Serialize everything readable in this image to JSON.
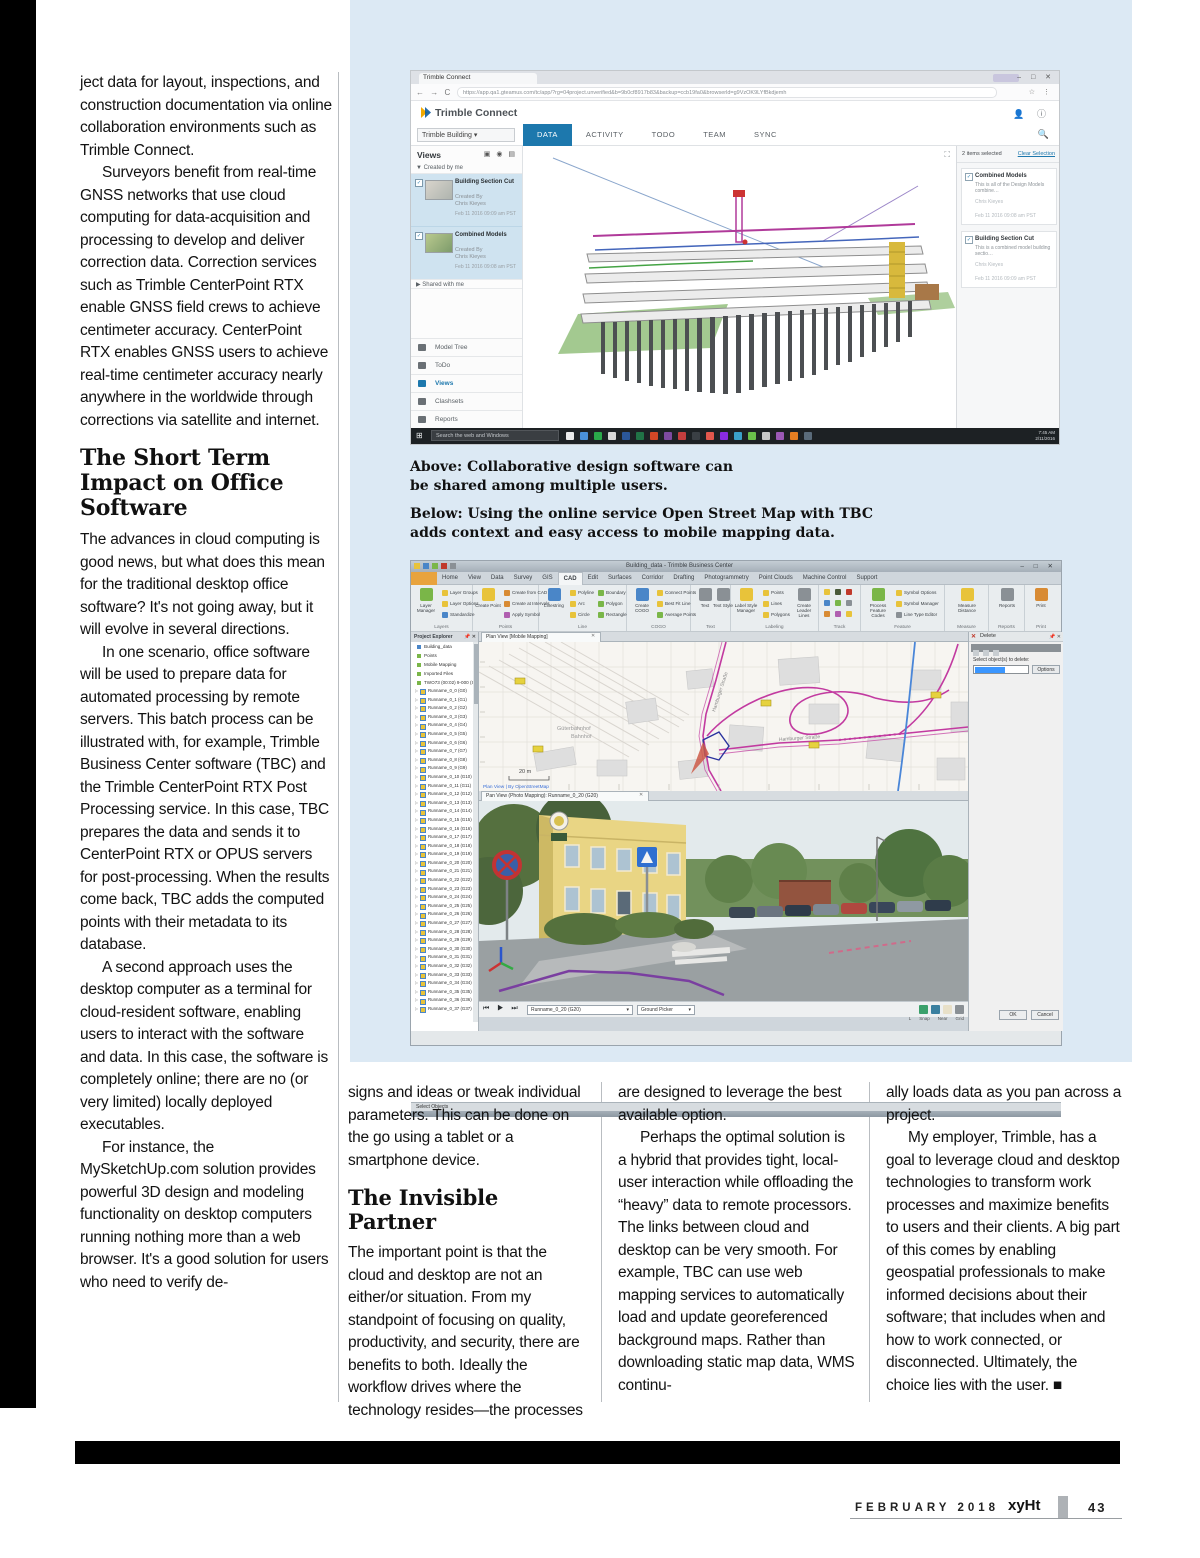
{
  "article": {
    "left_column": {
      "para1": "ject data for layout, inspections, and construction documentation via online collaboration environments such as Trimble Connect.",
      "para2": "Surveyors benefit from real-time GNSS networks that use cloud computing for data-acquisition and processing to develop and deliver correction data. Correction services such as Trimble CenterPoint RTX enable GNSS field crews to achieve centimeter accuracy. CenterPoint RTX enables GNSS users to achieve real-time centimeter accuracy nearly anywhere in the worldwide through corrections via satellite and internet.",
      "heading": "The Short Term Impact on Office Software",
      "para3": "The advances in cloud computing is good news, but what does this mean for the traditional desktop office software? It's not going away, but it will evolve in several directions.",
      "para4": "In one scenario, office software will be used to prepare data for automated processing by remote servers. This batch process can be illustrated with, for example, Trimble Business Center software (TBC) and the Trimble CenterPoint RTX Post Processing service. In this case, TBC prepares the data and sends it to CenterPoint RTX or OPUS servers for post-processing. When the results come back, TBC adds the computed points with their metadata to its database.",
      "para5": "A second approach uses the desktop computer as a terminal for cloud-resident software, enabling users to interact with the software and data. In this case, the software is completely online; there are no (or very limited) locally deployed executables.",
      "para6": "For instance, the MySketchUp.com solution provides powerful 3D design and modeling functionality on desktop computers running nothing more than a web browser. It's a good solution for users who need to verify de-"
    },
    "captions": {
      "above": "Above: Collaborative design software can be shared among multiple users.",
      "below": "Below: Using the online service Open Street Map with TBC adds context and easy access to mobile mapping data."
    },
    "columns": {
      "col1_para1": "signs and ideas or tweak individual parameters. This can be done on the go using a tablet or a smartphone device.",
      "col1_heading": "The Invisible Partner",
      "col1_para2": "The important point is that the cloud and desktop are not an either/or situation. From my standpoint of focusing on quality, productivity, and security, there are benefits to both. Ideally the workflow drives where the technology resides—the processes",
      "col2_para1": "are designed to leverage the best available option.",
      "col2_para2": "Perhaps the optimal solution is a hybrid that provides tight, local-user interaction while offloading the “heavy” data to remote processors. The links between cloud and desktop can be very smooth. For example, TBC can use web mapping services to automatically load and update georeferenced background maps. Rather than downloading static map data, WMS continu-",
      "col3_para1": "ally loads data as you pan across a project.",
      "col3_para2": "My employer, Trimble, has a goal to leverage cloud and desktop technologies to transform work processes and maximize benefits to users and their clients. A big part of this comes by enabling geospatial professionals to make informed decisions about their software; that includes when and how to work connected, or disconnected. Ultimately, the choice lies with the user. ■"
    },
    "footer": {
      "date": "FEBRUARY 2018",
      "brand": "xyHt",
      "page": "43"
    }
  },
  "tc": {
    "browser": {
      "tab_title": "Trimble Connect",
      "url": "https://app.qa1.gteamus.com/tc/app/?rg=04project.unverified&b=9b0cf8917b83&backup=ccb19fa0&browserld=g9VzOK9LYfBkdjemh"
    },
    "brand": "Trimble Connect",
    "project_selector": "Trimble Building ▾",
    "tabs": [
      {
        "label": "DATA"
      },
      {
        "label": "ACTIVITY"
      },
      {
        "label": "TODO"
      },
      {
        "label": "TEAM"
      },
      {
        "label": "SYNC"
      }
    ],
    "left": {
      "views_label": "Views",
      "created_group": "▼ Created by me",
      "shared_group": "▶ Shared with me",
      "items": [
        {
          "title": "Building Section Cut",
          "by": "Created By",
          "author": "Chris Kieyes",
          "date": "Feb 11 2016 09:09 am PST"
        },
        {
          "title": "Combined Models",
          "by": "Created By",
          "author": "Chris Kieyes",
          "date": "Feb 11 2016 09:08 am PST"
        }
      ],
      "nav": [
        "Model Tree",
        "ToDo",
        "Views",
        "Clashsets",
        "Reports"
      ]
    },
    "right": {
      "count_label": "2 items selected",
      "clear_label": "Clear Selection",
      "items": [
        {
          "title": "Combined Models",
          "desc": "This is all of the Design Models combine…",
          "author": "Chris Kieyes",
          "date": "Feb 11 2016 09:08 am PST"
        },
        {
          "title": "Building Section Cut",
          "desc": "This is a combined model building sectio…",
          "author": "Chris Kieyes",
          "date": "Feb 11 2016 09:09 am PST"
        }
      ]
    },
    "taskbar": {
      "search": "Search the web and Windows",
      "time": "7:45 AM",
      "date": "2/11/2016"
    }
  },
  "tbc": {
    "title": "Building_data - Trimble Business Center",
    "ribbon_tabs": [
      {
        "label": "Home"
      },
      {
        "label": "View"
      },
      {
        "label": "Data"
      },
      {
        "label": "Survey"
      },
      {
        "label": "GIS"
      },
      {
        "label": "CAD"
      },
      {
        "label": "Edit"
      },
      {
        "label": "Surfaces"
      },
      {
        "label": "Corridor"
      },
      {
        "label": "Drafting"
      },
      {
        "label": "Photogrammetry"
      },
      {
        "label": "Point Clouds"
      },
      {
        "label": "Machine Control"
      },
      {
        "label": "Support"
      }
    ],
    "ribbon": {
      "layers": {
        "big": "Layer Manager",
        "i1": "Layer Groups",
        "i2": "Layer Options",
        "i3": "Standardize",
        "label": "Layers"
      },
      "points": {
        "big": "Create Point",
        "i1": "Create from CAD",
        "i2": "Create at Intervals",
        "i3": "Apply Symbol",
        "label": "Points"
      },
      "line": {
        "big": "Linestring",
        "a1": "Polyline",
        "a2": "Arc",
        "a3": "Circle",
        "b1": "Boundary",
        "b2": "Polygon",
        "b3": "Rectangle",
        "label": "Line"
      },
      "cogo": {
        "big": "Create COGO",
        "i1": "Connect Points",
        "i2": "Best Fit Line",
        "i3": "Average Points",
        "label": "COGO"
      },
      "text": {
        "b1": "Text",
        "b2": "Text Style",
        "label": "Text"
      },
      "labeling": {
        "big": "Label Style Manager",
        "i1": "Points",
        "i2": "Lines",
        "i3": "Polygons",
        "big2": "Create Leader Lines",
        "label": "Labeling"
      },
      "track": {
        "label": "Track"
      },
      "feature": {
        "big": "Process Feature Codes",
        "i1": "Symbol Options",
        "i2": "Symbol Manager",
        "i3": "Line Type Editor",
        "label": "Feature"
      },
      "measure": {
        "big": "Measure Distance",
        "label": "Measure"
      },
      "reports": {
        "big": "Reports",
        "label": "Reports"
      },
      "print": {
        "big": "Print",
        "label": "Print"
      }
    },
    "explorer": {
      "title": "Project Explorer",
      "root": "Building_data",
      "nodes": [
        "Points",
        "Mobile Mapping",
        "Imported Files",
        "TWO73 (00:02) 9-000 (Sh…"
      ],
      "runs": [
        "Runname_0_0 (G0)",
        "Runname_0_1 (G1)",
        "Runname_0_2 (G2)",
        "Runname_0_3 (G3)",
        "Runname_0_4 (G4)",
        "Runname_0_5 (G5)",
        "Runname_0_6 (G6)",
        "Runname_0_7 (G7)",
        "Runname_0_8 (G8)",
        "Runname_0_9 (G9)",
        "Runname_0_10 (G10)",
        "Runname_0_11 (G11)",
        "Runname_0_12 (G12)",
        "Runname_0_13 (G13)",
        "Runname_0_14 (G14)",
        "Runname_0_15 (G15)",
        "Runname_0_16 (G16)",
        "Runname_0_17 (G17)",
        "Runname_0_18 (G18)",
        "Runname_0_19 (G19)",
        "Runname_0_20 (G20)",
        "Runname_0_21 (G21)",
        "Runname_0_22 (G22)",
        "Runname_0_23 (G23)",
        "Runname_0_24 (G24)",
        "Runname_0_25 (G25)",
        "Runname_0_26 (G26)",
        "Runname_0_27 (G27)",
        "Runname_0_28 (G28)",
        "Runname_0_29 (G29)",
        "Runname_0_30 (G30)",
        "Runname_0_31 (G31)",
        "Runname_0_32 (G32)",
        "Runname_0_33 (G33)",
        "Runname_0_34 (G34)",
        "Runname_0_35 (G35)",
        "Runname_0_36 (G36)",
        "Runname_0_37 (G37)"
      ]
    },
    "plan": {
      "tab": "Plan View [Mobile Mapping]",
      "label_station1": "Güterbahnhof",
      "label_station2": "Bahnhof",
      "label_road1": "Hamburger Straße",
      "label_road2": "Hamburger Straße",
      "scale": "20 m",
      "credit": "Plan View | By OpenStreetMap"
    },
    "pan": {
      "tab": "Pan View (Photo Mapping): Runname_0_20 (G20)",
      "run_value": "Runname_0_20 (G20)",
      "mode_value": "Ground Picker",
      "status": [
        "L",
        "Snap",
        "Near",
        "Grid"
      ]
    },
    "dialog": {
      "title": "Delete",
      "prompt": "Select object(s) to delete:",
      "options": "Options",
      "ok": "OK",
      "cancel": "Cancel"
    },
    "status": "Select Objects"
  }
}
